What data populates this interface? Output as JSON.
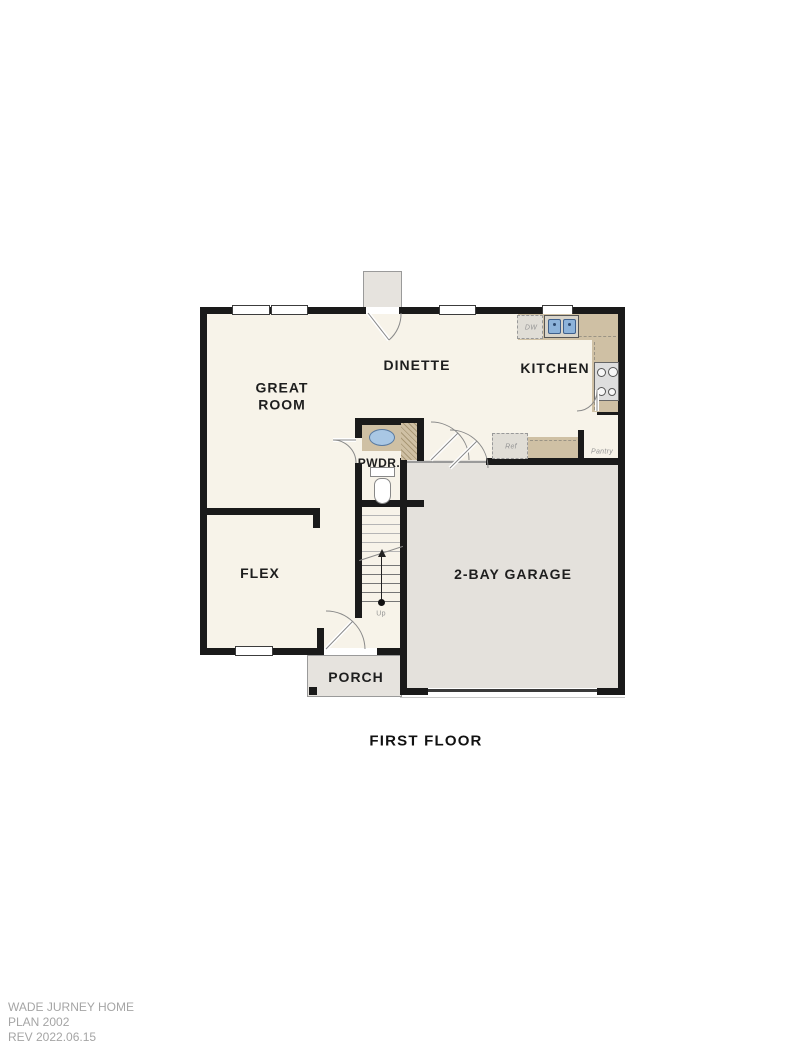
{
  "title": "FIRST FLOOR",
  "rooms": {
    "great_room": "GREAT ROOM",
    "dinette": "DINETTE",
    "kitchen": "KITCHEN",
    "powder": "PWDR.",
    "flex": "FLEX",
    "garage": "2-BAY GARAGE",
    "porch": "PORCH"
  },
  "fixtures": {
    "dishwasher": "DW",
    "refrigerator": "Ref",
    "pantry": "Pantry",
    "stairs_direction": "Up"
  },
  "footer": {
    "company": "WADE JURNEY HOME",
    "plan": "PLAN 2002",
    "revision": "REV 2022.06.15"
  },
  "colors": {
    "floor": "#f7f3e9",
    "garage_floor": "#e4e1dc",
    "porch_floor": "#e6e3de",
    "counter": "#cfc0a4",
    "wall": "#1a1a1a",
    "sink": "#8db3da",
    "label": "#1e1e1e",
    "muted": "#949494",
    "footer_text": "#a5a5a5"
  }
}
